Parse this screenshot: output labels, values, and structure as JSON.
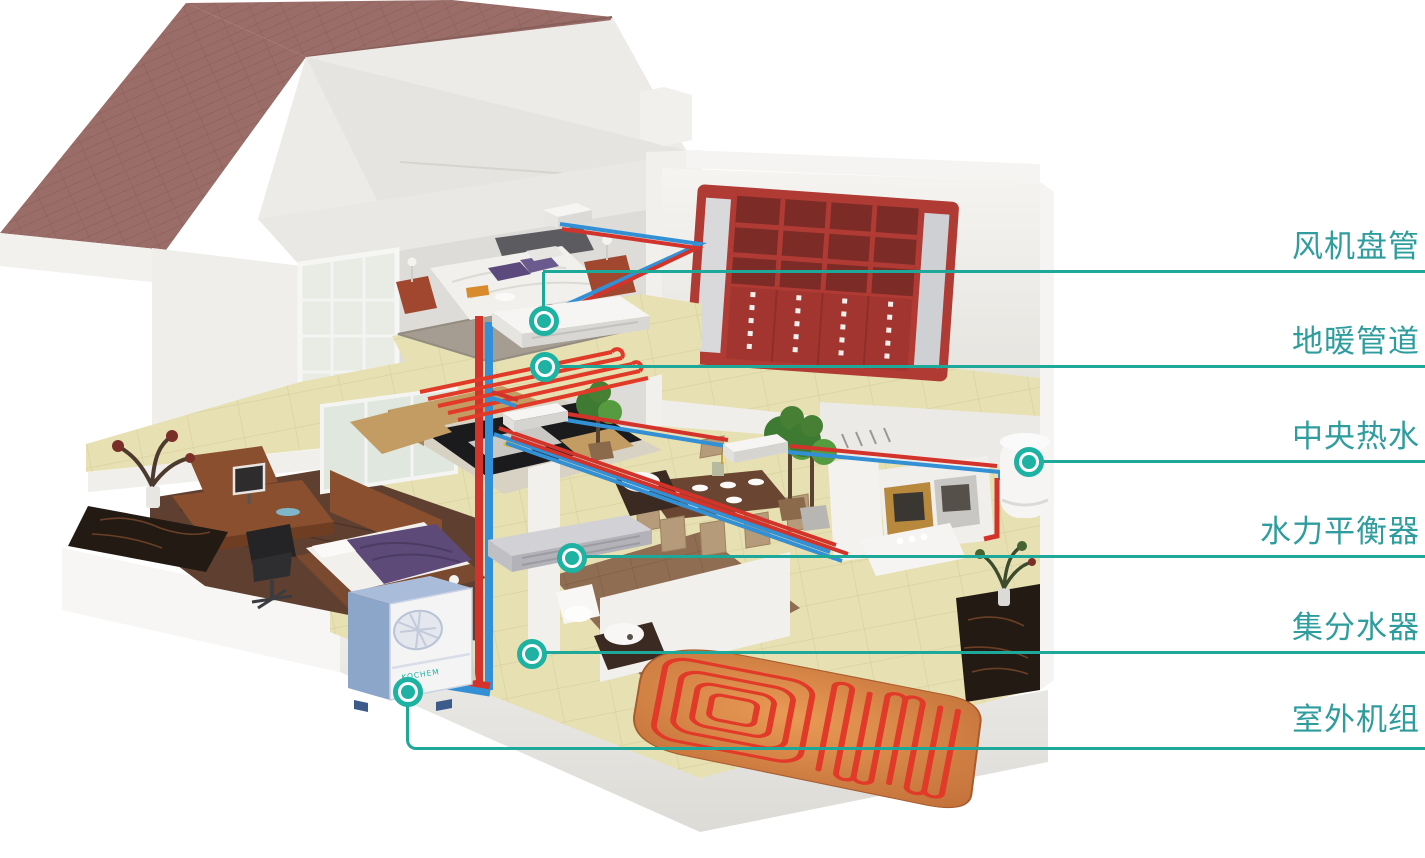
{
  "canvas": {
    "width": 1425,
    "height": 858,
    "background": "#ffffff"
  },
  "callouts": {
    "line_color": "#1ea89a",
    "text_color": "#2f9d9e",
    "items": [
      {
        "id": "fan-coil-unit",
        "label": "风机盘管"
      },
      {
        "id": "floor-heating-pipes",
        "label": "地暖管道"
      },
      {
        "id": "central-hot-water",
        "label": "中央热水"
      },
      {
        "id": "hydraulic-balancer",
        "label": "水力平衡器"
      },
      {
        "id": "manifold",
        "label": "集分水器"
      },
      {
        "id": "outdoor-unit",
        "label": "室外机组"
      }
    ]
  },
  "illustration": {
    "type": "3d-cutaway-house-with-hvac-heating-system",
    "outdoor_unit_logo": "KOCHEM",
    "colors": {
      "roof_tile": "#9b6d68",
      "wall_white": "#eceae6",
      "floor_tile_yellow": "#e7e0b2",
      "furniture_red": "#b03a34",
      "pipe_hot": "#d2342b",
      "pipe_cold": "#3390d4",
      "heating_coil": "#e23a28",
      "marker_teal": "#1db2a2"
    }
  }
}
